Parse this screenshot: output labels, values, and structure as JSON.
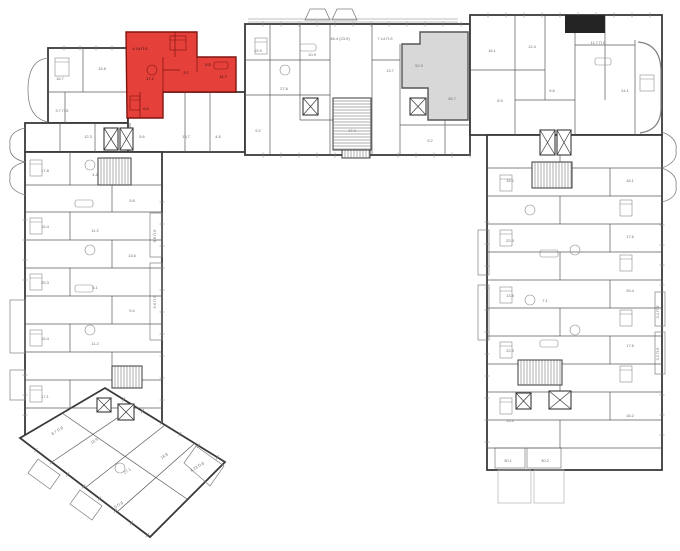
{
  "meta": {
    "description": "Residential building floor plan, U-shaped, with one apartment highlighted red and one highlighted gray",
    "canvas": {
      "w": 680,
      "h": 551
    }
  },
  "colors": {
    "background": "#ffffff",
    "outer_wall": "#3a3a3a",
    "partition_wall": "#5a5a5a",
    "light_detail": "#8a8a8a",
    "balcony_line": "#808080",
    "terrace_line": "#b2b2b2",
    "highlight_red_fill": "#e6403a",
    "highlight_red_stroke": "#801510",
    "highlight_gray_fill": "#d8d8d8",
    "highlight_gray_stroke": "#565656",
    "core_black": "#242424",
    "label_text": "#6f6f6f",
    "red_label_text": "#2d1513"
  },
  "blocks": [
    {
      "type": "rect",
      "x": 48,
      "y": 48,
      "w": 80,
      "h": 75
    },
    {
      "type": "rect",
      "x": 25,
      "y": 123,
      "w": 137,
      "h": 29
    },
    {
      "type": "rect",
      "x": 128,
      "y": 92,
      "w": 117,
      "h": 60
    },
    {
      "type": "rect",
      "x": 25,
      "y": 152,
      "w": 137,
      "h": 283
    },
    {
      "type": "rect",
      "x": 245,
      "y": 24,
      "w": 225,
      "h": 131
    },
    {
      "type": "rect",
      "x": 470,
      "y": 15,
      "w": 192,
      "h": 120
    },
    {
      "type": "rect",
      "x": 487,
      "y": 135,
      "w": 175,
      "h": 335
    },
    {
      "type": "polygon",
      "points": "20,438 105,388 225,462 150,537"
    }
  ],
  "highlighted_units": [
    {
      "id": "red-apartment",
      "points": "126,32 197,32 197,57 236,57 236,92 163,92 163,118 127,118",
      "inner_walls": [
        [
          163,
          57,
          163,
          92
        ],
        [
          197,
          57,
          197,
          72
        ],
        [
          175,
          32,
          175,
          57
        ],
        [
          140,
          92,
          140,
          118
        ],
        [
          163,
          70,
          180,
          70
        ]
      ],
      "labels": [
        {
          "t": "17.2",
          "x": 150,
          "y": 80
        },
        {
          "t": "3.7",
          "x": 186,
          "y": 74
        },
        {
          "t": "5.5",
          "x": 208,
          "y": 66
        },
        {
          "t": "11.7",
          "x": 223,
          "y": 78
        },
        {
          "t": "4.14 П.б",
          "x": 140,
          "y": 50
        },
        {
          "t": "6.5",
          "x": 146,
          "y": 110
        }
      ]
    },
    {
      "id": "gray-apartment",
      "points": "402,44 420,44 420,32 468,32 468,120 428,120 428,88 402,88",
      "inner_walls": [],
      "labels": [
        {
          "t": "52.9",
          "x": 419,
          "y": 67
        },
        {
          "t": "36.7",
          "x": 452,
          "y": 100
        }
      ]
    }
  ],
  "core_blacks": [
    {
      "x": 565,
      "y": 15,
      "w": 40,
      "h": 18
    }
  ],
  "walls": [
    [
      83,
      48,
      83,
      92
    ],
    [
      48,
      92,
      128,
      92
    ],
    [
      65,
      92,
      65,
      123
    ],
    [
      60,
      123,
      60,
      152
    ],
    [
      95,
      123,
      95,
      152
    ],
    [
      130,
      123,
      130,
      152
    ],
    [
      185,
      92,
      185,
      152
    ],
    [
      210,
      92,
      210,
      152
    ],
    [
      25,
      185,
      162,
      185
    ],
    [
      25,
      212,
      162,
      212
    ],
    [
      25,
      240,
      162,
      240
    ],
    [
      25,
      268,
      162,
      268
    ],
    [
      25,
      296,
      162,
      296
    ],
    [
      25,
      324,
      162,
      324
    ],
    [
      25,
      352,
      162,
      352
    ],
    [
      25,
      380,
      162,
      380
    ],
    [
      25,
      408,
      162,
      408
    ],
    [
      70,
      152,
      70,
      185
    ],
    [
      70,
      212,
      70,
      240
    ],
    [
      70,
      268,
      70,
      296
    ],
    [
      70,
      324,
      70,
      352
    ],
    [
      70,
      380,
      70,
      408
    ],
    [
      112,
      185,
      112,
      212
    ],
    [
      112,
      240,
      112,
      268
    ],
    [
      112,
      296,
      112,
      324
    ],
    [
      112,
      352,
      112,
      380
    ],
    [
      270,
      24,
      270,
      155
    ],
    [
      300,
      24,
      300,
      120
    ],
    [
      330,
      24,
      330,
      155
    ],
    [
      372,
      24,
      372,
      155
    ],
    [
      400,
      44,
      400,
      155
    ],
    [
      445,
      120,
      445,
      155
    ],
    [
      245,
      60,
      330,
      60
    ],
    [
      245,
      95,
      330,
      95
    ],
    [
      300,
      120,
      372,
      120
    ],
    [
      372,
      60,
      400,
      60
    ],
    [
      400,
      125,
      470,
      125
    ],
    [
      515,
      15,
      515,
      135
    ],
    [
      545,
      15,
      545,
      100
    ],
    [
      575,
      33,
      575,
      135
    ],
    [
      605,
      15,
      605,
      100
    ],
    [
      635,
      40,
      635,
      135
    ],
    [
      470,
      70,
      545,
      70
    ],
    [
      515,
      100,
      575,
      100
    ],
    [
      575,
      45,
      635,
      45
    ],
    [
      487,
      168,
      662,
      168
    ],
    [
      487,
      196,
      662,
      196
    ],
    [
      487,
      224,
      662,
      224
    ],
    [
      487,
      252,
      662,
      252
    ],
    [
      487,
      280,
      662,
      280
    ],
    [
      487,
      308,
      662,
      308
    ],
    [
      487,
      336,
      662,
      336
    ],
    [
      487,
      364,
      662,
      364
    ],
    [
      487,
      392,
      662,
      392
    ],
    [
      487,
      420,
      662,
      420
    ],
    [
      487,
      448,
      662,
      448
    ],
    [
      560,
      135,
      560,
      168
    ],
    [
      560,
      196,
      560,
      224
    ],
    [
      560,
      252,
      560,
      280
    ],
    [
      560,
      308,
      560,
      336
    ],
    [
      560,
      364,
      560,
      392
    ],
    [
      560,
      420,
      560,
      448
    ],
    [
      610,
      168,
      610,
      196
    ],
    [
      610,
      224,
      610,
      252
    ],
    [
      610,
      280,
      610,
      308
    ],
    [
      610,
      336,
      610,
      364
    ],
    [
      610,
      392,
      610,
      420
    ],
    [
      135,
      406,
      52,
      462
    ],
    [
      165,
      425,
      85,
      488
    ],
    [
      195,
      443,
      117,
      512
    ],
    [
      62,
      413,
      187,
      499
    ]
  ],
  "windows": [
    {
      "x1": 48,
      "y1": 48,
      "x2": 128,
      "y2": 48,
      "step": 16
    },
    {
      "x1": 245,
      "y1": 24,
      "x2": 470,
      "y2": 24,
      "step": 18
    },
    {
      "x1": 470,
      "y1": 15,
      "x2": 662,
      "y2": 15,
      "step": 18
    },
    {
      "x1": 25,
      "y1": 200,
      "x2": 25,
      "y2": 295,
      "step": 20
    },
    {
      "x1": 25,
      "y1": 355,
      "x2": 25,
      "y2": 430,
      "step": 20
    },
    {
      "x1": 162,
      "y1": 180,
      "x2": 162,
      "y2": 420,
      "step": 22
    },
    {
      "x1": 662,
      "y1": 205,
      "x2": 662,
      "y2": 288,
      "step": 20
    },
    {
      "x1": 662,
      "y1": 375,
      "x2": 662,
      "y2": 445,
      "step": 20
    },
    {
      "x1": 487,
      "y1": 200,
      "x2": 487,
      "y2": 455,
      "step": 22
    },
    {
      "x1": 245,
      "y1": 155,
      "x2": 338,
      "y2": 155,
      "step": 18
    },
    {
      "x1": 380,
      "y1": 155,
      "x2": 470,
      "y2": 155,
      "step": 18
    },
    {
      "x1": 20,
      "y1": 438,
      "x2": 150,
      "y2": 537,
      "step": 20
    },
    {
      "x1": 105,
      "y1": 388,
      "x2": 225,
      "y2": 462,
      "step": 22
    }
  ],
  "stairs": [
    {
      "x": 98,
      "y": 158,
      "w": 33,
      "h": 27,
      "dir": "v"
    },
    {
      "x": 112,
      "y": 366,
      "w": 30,
      "h": 22,
      "dir": "v"
    },
    {
      "x": 333,
      "y": 98,
      "w": 38,
      "h": 52,
      "dir": "h"
    },
    {
      "x": 532,
      "y": 162,
      "w": 40,
      "h": 26,
      "dir": "v"
    },
    {
      "x": 518,
      "y": 360,
      "w": 44,
      "h": 25,
      "dir": "v"
    },
    {
      "x": 342,
      "y": 150,
      "w": 28,
      "h": 8,
      "dir": "v"
    }
  ],
  "elevators": [
    {
      "x": 104,
      "y": 128,
      "w": 14,
      "h": 22
    },
    {
      "x": 120,
      "y": 128,
      "w": 13,
      "h": 22
    },
    {
      "x": 303,
      "y": 98,
      "w": 15,
      "h": 17
    },
    {
      "x": 410,
      "y": 98,
      "w": 16,
      "h": 17
    },
    {
      "x": 540,
      "y": 130,
      "w": 15,
      "h": 25
    },
    {
      "x": 557,
      "y": 130,
      "w": 14,
      "h": 25
    },
    {
      "x": 516,
      "y": 393,
      "w": 15,
      "h": 16
    },
    {
      "x": 549,
      "y": 391,
      "w": 22,
      "h": 18
    },
    {
      "x": 97,
      "y": 398,
      "w": 14,
      "h": 14
    },
    {
      "x": 118,
      "y": 404,
      "w": 16,
      "h": 16
    }
  ],
  "balcony_rects": [
    {
      "x": 10,
      "y": 300,
      "w": 15,
      "h": 53,
      "light": false
    },
    {
      "x": 10,
      "y": 370,
      "w": 15,
      "h": 30,
      "light": false
    },
    {
      "x": 150,
      "y": 213,
      "w": 12,
      "h": 44,
      "light": false
    },
    {
      "x": 150,
      "y": 263,
      "w": 12,
      "h": 77,
      "light": false
    },
    {
      "x": 655,
      "y": 292,
      "w": 10,
      "h": 34,
      "light": false
    },
    {
      "x": 655,
      "y": 332,
      "w": 10,
      "h": 42,
      "light": false
    },
    {
      "x": 478,
      "y": 230,
      "w": 11,
      "h": 45,
      "light": false
    },
    {
      "x": 478,
      "y": 285,
      "w": 11,
      "h": 55,
      "light": false
    },
    {
      "x": 495,
      "y": 448,
      "w": 30,
      "h": 20,
      "light": false
    },
    {
      "x": 527,
      "y": 448,
      "w": 34,
      "h": 20,
      "light": false
    },
    {
      "x": 498,
      "y": 470,
      "w": 33,
      "h": 33,
      "light": true
    },
    {
      "x": 534,
      "y": 470,
      "w": 30,
      "h": 33,
      "light": true
    }
  ],
  "paths": [
    {
      "d": "M48,58 Q28,60 28,90 Q28,118 48,122",
      "sw": 0.8
    },
    {
      "d": "M25,128 Q8,132 10,145 Q8,158 25,162",
      "sw": 0.8
    },
    {
      "d": "M25,162 Q8,166 10,178 Q8,190 25,195",
      "sw": 0.8
    },
    {
      "d": "M662,132 Q678,138 676,150 Q678,162 662,168",
      "sw": 0.8
    },
    {
      "d": "M662,168 Q678,174 676,186 Q678,198 662,202",
      "sw": 0.8
    },
    {
      "d": "M638,42 Q661,44 661,72 L661,108 Q661,130 640,133",
      "sw": 1.2
    },
    {
      "d": "M305,20 L310,9 L325,9 L330,20 Z",
      "sw": 0.8
    },
    {
      "d": "M332,20 L337,9 L352,9 L357,20 Z",
      "sw": 0.8
    },
    {
      "d": "M248,19 L458,19",
      "sw": 0.6
    },
    {
      "d": "M248,22 L458,22",
      "sw": 0.6
    },
    {
      "d": "M38,459 L60,475 L50,489 L28,473 Z",
      "sw": 0.7
    },
    {
      "d": "M80,490 L102,506 L92,520 L70,504 Z",
      "sw": 0.7
    },
    {
      "d": "M196,446 L224,466 L210,486 L184,463 Z",
      "sw": 0.7
    }
  ],
  "furniture": [
    {
      "type": "bed",
      "x": 55,
      "y": 58,
      "w": 14,
      "h": 18
    },
    {
      "type": "bed",
      "x": 30,
      "y": 160,
      "w": 12,
      "h": 16
    },
    {
      "type": "bed",
      "x": 30,
      "y": 218,
      "w": 12,
      "h": 16
    },
    {
      "type": "bed",
      "x": 30,
      "y": 274,
      "w": 12,
      "h": 16
    },
    {
      "type": "bed",
      "x": 30,
      "y": 330,
      "w": 12,
      "h": 16
    },
    {
      "type": "bed",
      "x": 30,
      "y": 386,
      "w": 12,
      "h": 16
    },
    {
      "type": "bed",
      "x": 500,
      "y": 175,
      "w": 12,
      "h": 16
    },
    {
      "type": "bed",
      "x": 500,
      "y": 230,
      "w": 12,
      "h": 16
    },
    {
      "type": "bed",
      "x": 500,
      "y": 287,
      "w": 12,
      "h": 16
    },
    {
      "type": "bed",
      "x": 500,
      "y": 342,
      "w": 12,
      "h": 16
    },
    {
      "type": "bed",
      "x": 500,
      "y": 398,
      "w": 12,
      "h": 16
    },
    {
      "type": "bed",
      "x": 640,
      "y": 75,
      "w": 14,
      "h": 16
    },
    {
      "type": "bed",
      "x": 255,
      "y": 38,
      "w": 12,
      "h": 16
    },
    {
      "type": "bed",
      "x": 620,
      "y": 200,
      "w": 12,
      "h": 16
    },
    {
      "type": "bed",
      "x": 620,
      "y": 255,
      "w": 12,
      "h": 16
    },
    {
      "type": "bed",
      "x": 620,
      "y": 310,
      "w": 12,
      "h": 16
    },
    {
      "type": "bed",
      "x": 620,
      "y": 366,
      "w": 12,
      "h": 16
    },
    {
      "type": "table",
      "x": 90,
      "y": 165,
      "r": 5
    },
    {
      "type": "table",
      "x": 90,
      "y": 250,
      "r": 5
    },
    {
      "type": "table",
      "x": 90,
      "y": 330,
      "r": 5
    },
    {
      "type": "table",
      "x": 530,
      "y": 210,
      "r": 5
    },
    {
      "type": "table",
      "x": 530,
      "y": 300,
      "r": 5
    },
    {
      "type": "table",
      "x": 575,
      "y": 250,
      "r": 5
    },
    {
      "type": "table",
      "x": 575,
      "y": 330,
      "r": 5
    },
    {
      "type": "table",
      "x": 285,
      "y": 70,
      "r": 5
    },
    {
      "type": "table",
      "x": 120,
      "y": 468,
      "r": 5
    },
    {
      "type": "sofa",
      "x": 75,
      "y": 200,
      "w": 18,
      "h": 7
    },
    {
      "type": "sofa",
      "x": 75,
      "y": 285,
      "w": 18,
      "h": 7
    },
    {
      "type": "sofa",
      "x": 540,
      "y": 250,
      "w": 18,
      "h": 7
    },
    {
      "type": "sofa",
      "x": 540,
      "y": 340,
      "w": 18,
      "h": 7
    },
    {
      "type": "sofa",
      "x": 300,
      "y": 44,
      "w": 16,
      "h": 7
    },
    {
      "type": "sofa",
      "x": 595,
      "y": 58,
      "w": 16,
      "h": 7
    }
  ],
  "red_furniture": [
    {
      "type": "bed",
      "x": 170,
      "y": 36,
      "w": 16,
      "h": 14
    },
    {
      "type": "table",
      "x": 152,
      "y": 70,
      "r": 5
    },
    {
      "type": "sofa",
      "x": 214,
      "y": 62,
      "w": 14,
      "h": 7
    },
    {
      "type": "bed",
      "x": 130,
      "y": 96,
      "w": 10,
      "h": 14
    }
  ],
  "labels": [
    {
      "t": "16.7",
      "x": 60,
      "y": 80
    },
    {
      "t": "15.8",
      "x": 102,
      "y": 70
    },
    {
      "t": "9.7 П.б",
      "x": 62,
      "y": 112
    },
    {
      "t": "12.3",
      "x": 88,
      "y": 138
    },
    {
      "t": "5.6",
      "x": 142,
      "y": 138
    },
    {
      "t": "13.7",
      "x": 186,
      "y": 138
    },
    {
      "t": "4.8",
      "x": 218,
      "y": 138
    },
    {
      "t": "17.8",
      "x": 45,
      "y": 172
    },
    {
      "t": "4.2",
      "x": 95,
      "y": 176
    },
    {
      "t": "16.4",
      "x": 45,
      "y": 228
    },
    {
      "t": "11.2",
      "x": 95,
      "y": 232
    },
    {
      "t": "25.3",
      "x": 45,
      "y": 284
    },
    {
      "t": "5.1",
      "x": 95,
      "y": 289
    },
    {
      "t": "16.4",
      "x": 45,
      "y": 340
    },
    {
      "t": "11.2",
      "x": 95,
      "y": 345
    },
    {
      "t": "17.1",
      "x": 45,
      "y": 398
    },
    {
      "t": "3.8",
      "x": 132,
      "y": 202
    },
    {
      "t": "13.6",
      "x": 132,
      "y": 257
    },
    {
      "t": "9.4",
      "x": 132,
      "y": 312
    },
    {
      "t": "9.6 П.б",
      "x": 156,
      "y": 236,
      "r": -90
    },
    {
      "t": "9.6 П.б",
      "x": 156,
      "y": 302,
      "r": -90
    },
    {
      "t": "15.9",
      "x": 258,
      "y": 52
    },
    {
      "t": "27.6",
      "x": 284,
      "y": 90
    },
    {
      "t": "10.9",
      "x": 312,
      "y": 56
    },
    {
      "t": "46.4 (23.9)",
      "x": 340,
      "y": 40
    },
    {
      "t": "7.14 П.б",
      "x": 385,
      "y": 40
    },
    {
      "t": "13.7",
      "x": 390,
      "y": 72
    },
    {
      "t": "17.4",
      "x": 352,
      "y": 132
    },
    {
      "t": "9.2",
      "x": 430,
      "y": 142
    },
    {
      "t": "9.2",
      "x": 258,
      "y": 132
    },
    {
      "t": "16.1",
      "x": 492,
      "y": 52
    },
    {
      "t": "12.4",
      "x": 532,
      "y": 48
    },
    {
      "t": "11.7 П.б",
      "x": 598,
      "y": 44
    },
    {
      "t": "24.1",
      "x": 625,
      "y": 92
    },
    {
      "t": "8.9",
      "x": 500,
      "y": 102
    },
    {
      "t": "5.6",
      "x": 552,
      "y": 92
    },
    {
      "t": "15.2",
      "x": 510,
      "y": 182
    },
    {
      "t": "16.1",
      "x": 630,
      "y": 182
    },
    {
      "t": "22.3",
      "x": 510,
      "y": 242
    },
    {
      "t": "17.6",
      "x": 630,
      "y": 238
    },
    {
      "t": "13.8",
      "x": 510,
      "y": 297
    },
    {
      "t": "25.4",
      "x": 630,
      "y": 292
    },
    {
      "t": "22.3",
      "x": 510,
      "y": 352
    },
    {
      "t": "17.6",
      "x": 630,
      "y": 347
    },
    {
      "t": "15.2",
      "x": 510,
      "y": 422
    },
    {
      "t": "16.2",
      "x": 630,
      "y": 417
    },
    {
      "t": "7.1",
      "x": 545,
      "y": 302
    },
    {
      "t": "3.1 П.б",
      "x": 659,
      "y": 312,
      "r": -90
    },
    {
      "t": "3.2 П.б",
      "x": 659,
      "y": 354,
      "r": -90
    },
    {
      "t": "30.1",
      "x": 508,
      "y": 462
    },
    {
      "t": "30.2",
      "x": 545,
      "y": 462
    },
    {
      "t": "15.9",
      "x": 95,
      "y": 442,
      "r": -32
    },
    {
      "t": "27.1",
      "x": 128,
      "y": 472,
      "r": -32
    },
    {
      "t": "16.8",
      "x": 165,
      "y": 457,
      "r": -32
    },
    {
      "t": "7.5 П.б",
      "x": 118,
      "y": 507,
      "r": -32
    },
    {
      "t": "8.23 П.б",
      "x": 198,
      "y": 468,
      "r": -32
    },
    {
      "t": "8.7 П.б",
      "x": 58,
      "y": 432,
      "r": -32
    }
  ]
}
